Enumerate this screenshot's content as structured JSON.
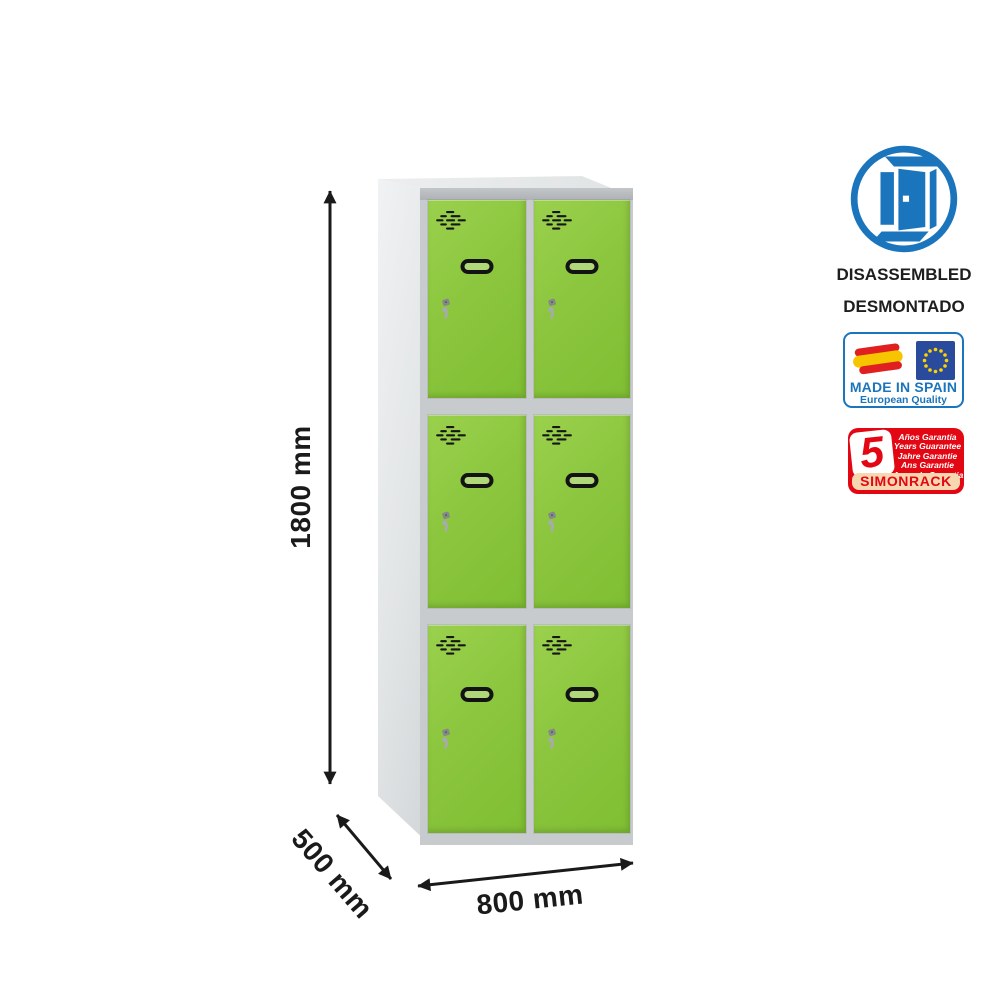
{
  "dimensions": {
    "height": "1800 mm",
    "depth": "500 mm",
    "width": "800 mm"
  },
  "locker": {
    "rows": 3,
    "columns": 2
  },
  "badges": {
    "disassembled": {
      "line1": "DISASSEMBLED",
      "line2": "DESMONTADO"
    },
    "made_in_spain": {
      "title": "MADE IN SPAIN",
      "subtitle": "European Quality"
    },
    "guarantee": {
      "years": "5",
      "lines": [
        "Años Garantía",
        "Years Guarantee",
        "Jahre Garantie",
        "Ans Garantie",
        "Anos de Garantia"
      ],
      "brand": "SIMONRACK"
    }
  },
  "colors": {
    "door_green": "#8cc63e",
    "frame_gray": "#c7cbcd",
    "brand_blue": "#1b75bc",
    "brand_red": "#e30613",
    "guarantee_strip": "#f6d7b0"
  }
}
